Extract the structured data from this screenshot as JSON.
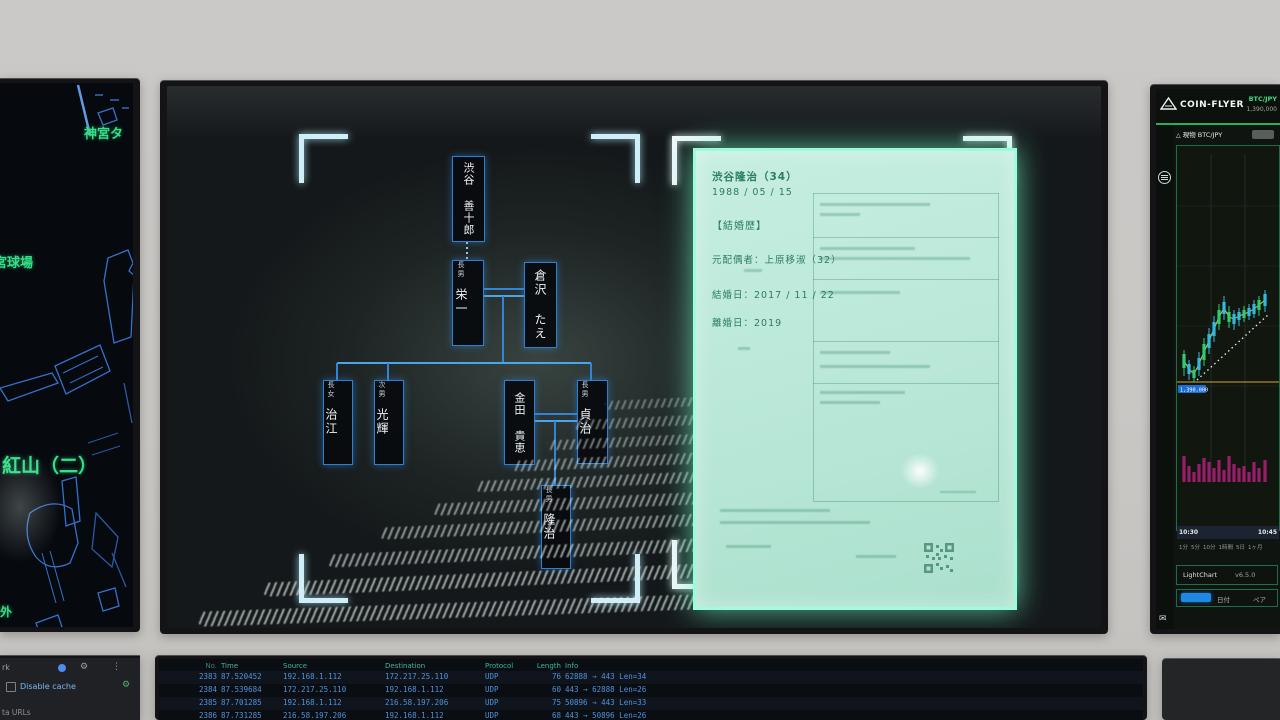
{
  "left_monitor": {
    "labels": {
      "jingu": "神宮タ",
      "stadium": "宮球場",
      "beniyama": "紅山（二）",
      "corner": "外"
    }
  },
  "center_monitor": {
    "tree": {
      "zenjuro": {
        "role": "",
        "name": "渋谷 善十郎"
      },
      "eiichi": {
        "role": "長男",
        "name": "栄一"
      },
      "tae": {
        "role": "",
        "name": "倉沢 たえ"
      },
      "harue": {
        "role": "長女",
        "name": "治江"
      },
      "koki": {
        "role": "次男",
        "name": "光輝"
      },
      "takae": {
        "role": "",
        "name": "金田 貴恵"
      },
      "sadaharu": {
        "role": "長男",
        "name": "貞治"
      },
      "ryuji": {
        "role": "長男",
        "name": "隆治"
      }
    },
    "document": {
      "name_line": "渋谷隆治（34）",
      "birth_date": "1988 / 05 / 15",
      "section_title": "【結婚歴】",
      "ex_spouse": "元配偶者：上原移淑（32）",
      "marriage_date": "結婚日：2017 / 11 / 22",
      "divorce_date": "離婚日：2019"
    }
  },
  "right_monitor": {
    "brand": "COIN-FLYER",
    "pair": "BTC/JPY",
    "price": "1,390,000",
    "subheader_label": "現物 BTC/JPY",
    "price_line_label": "1,390,000",
    "time_axis": [
      "10:30",
      "10:45"
    ],
    "timeframes": [
      "1分",
      "5分",
      "10分",
      "1時間",
      "5日",
      "1ヶ月"
    ],
    "footer_engine": "LightChart",
    "footer_version": "v6.5.0",
    "footer_date_label": "日付",
    "footer_pair_label": "ペア",
    "chart": {
      "type": "candlestick",
      "candles": [
        [
          7,
          204,
          208,
          222,
          230,
          "g"
        ],
        [
          12,
          214,
          218,
          228,
          234,
          "c"
        ],
        [
          17,
          220,
          224,
          232,
          236,
          "g"
        ],
        [
          22,
          206,
          212,
          224,
          230,
          "c"
        ],
        [
          27,
          192,
          198,
          214,
          220,
          "g"
        ],
        [
          32,
          182,
          188,
          202,
          208,
          "c"
        ],
        [
          37,
          170,
          176,
          190,
          196,
          "c"
        ],
        [
          42,
          158,
          164,
          178,
          184,
          "g"
        ],
        [
          47,
          150,
          156,
          168,
          174,
          "c"
        ],
        [
          52,
          160,
          166,
          176,
          182,
          "g"
        ],
        [
          57,
          164,
          168,
          178,
          184,
          "c"
        ],
        [
          62,
          162,
          166,
          174,
          180,
          "c"
        ],
        [
          67,
          160,
          164,
          172,
          176,
          "g"
        ],
        [
          72,
          158,
          162,
          170,
          174,
          "c"
        ],
        [
          77,
          154,
          158,
          168,
          172,
          "c"
        ],
        [
          82,
          150,
          154,
          164,
          170,
          "g"
        ],
        [
          88,
          144,
          148,
          160,
          166,
          "c"
        ]
      ],
      "volumes": [
        26,
        16,
        10,
        18,
        24,
        20,
        14,
        22,
        12,
        26,
        18,
        14,
        16,
        10,
        20,
        14,
        22
      ],
      "dotted_line": [
        20,
        234,
        92,
        168
      ],
      "yellow_line_y": 236,
      "colors": {
        "up": "#2ecc71",
        "alt": "#35b8e0",
        "ma": "#c6d94a",
        "yline": "#c8a93a",
        "volume": "#b1207a",
        "label_bg": "#1a6fd4"
      }
    }
  },
  "bottom_left": {
    "tab_fragment": "rk",
    "disable_cache_label": "Disable cache",
    "data_urls_fragment": "ta URLs"
  },
  "bottom_center": {
    "columns": [
      "No.",
      "Time",
      "Source",
      "Destination",
      "Protocol",
      "Length",
      "Info"
    ],
    "rows": [
      [
        "2383",
        "87.520452",
        "192.168.1.112",
        "172.217.25.110",
        "UDP",
        "76",
        "62888 → 443 Len=34"
      ],
      [
        "2384",
        "87.539684",
        "172.217.25.110",
        "192.168.1.112",
        "UDP",
        "60",
        "443 → 62888 Len=26"
      ],
      [
        "2385",
        "87.701285",
        "192.168.1.112",
        "216.58.197.206",
        "UDP",
        "75",
        "50896 → 443 Len=33"
      ],
      [
        "2386",
        "87.731285",
        "216.58.197.206",
        "192.168.1.112",
        "UDP",
        "68",
        "443 → 50896 Len=26"
      ]
    ]
  }
}
